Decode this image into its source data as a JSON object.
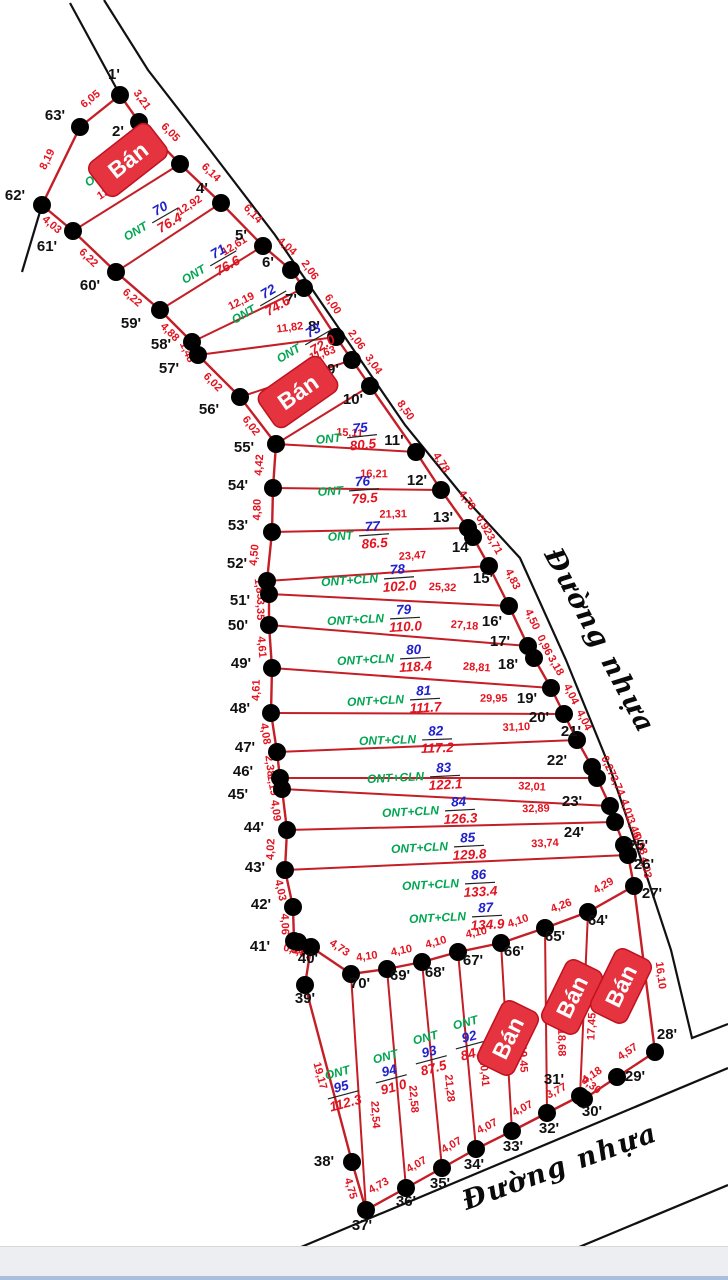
{
  "title": "Cadastral parcel sketch map",
  "colors": {
    "line": "#c41e26",
    "road": "#111111",
    "dot": "#000000",
    "edge_label": "#e4131f",
    "code": "#00a651",
    "num": "#2020cc",
    "area": "#e4131f",
    "badge_bg": "#e5333f",
    "badge_border": "#bf1120",
    "badge_text": "#ffffff",
    "vertex_label": "#111111",
    "bar": "#222222"
  },
  "roads": {
    "right_label": {
      "text": "Đường nhựa",
      "x": 592,
      "y": 645,
      "rot": 62,
      "size": 27
    },
    "bottom_label": {
      "text": "Đường nhựa",
      "x": 563,
      "y": 1175,
      "rot": -20,
      "size": 27
    },
    "lines": [
      [
        [
          104,
          0
        ],
        [
          148,
          70
        ],
        [
          210,
          150
        ],
        [
          275,
          235
        ],
        [
          340,
          330
        ],
        [
          405,
          425
        ],
        [
          462,
          495
        ],
        [
          520,
          558
        ],
        [
          566,
          660
        ],
        [
          610,
          768
        ],
        [
          648,
          880
        ],
        [
          671,
          950
        ],
        [
          692,
          1038
        ],
        [
          728,
          1024
        ]
      ],
      [
        [
          70,
          3
        ],
        [
          120,
          95
        ]
      ],
      [
        [
          42,
          205
        ],
        [
          22,
          272
        ]
      ],
      [
        [
          263,
          1263
        ],
        [
          728,
          1068
        ]
      ],
      [
        [
          500,
          1280
        ],
        [
          728,
          1185
        ]
      ]
    ]
  },
  "vertices": {
    "1": [
      120,
      95,
      -6,
      -16
    ],
    "2": [
      139,
      122,
      -21,
      14
    ],
    "3": [
      180,
      164,
      -20,
      -3
    ],
    "4": [
      221,
      203,
      -19,
      -10
    ],
    "5": [
      263,
      246,
      -22,
      -6
    ],
    "6": [
      291,
      270,
      -23,
      -3
    ],
    "7": [
      304,
      288,
      -13,
      16
    ],
    "8": [
      336,
      337,
      -22,
      -6
    ],
    "9": [
      352,
      360,
      -19,
      14
    ],
    "10": [
      370,
      386,
      -17,
      18
    ],
    "11": [
      416,
      452,
      -22,
      -7
    ],
    "12": [
      441,
      490,
      -24,
      -5
    ],
    "13": [
      468,
      528,
      -25,
      -6
    ],
    "13b": [
      473,
      537,
      0,
      0
    ],
    "14": [
      489,
      566,
      -27,
      -14
    ],
    "15": [
      509,
      606,
      -26,
      -23
    ],
    "16": [
      528,
      646,
      -36,
      -20
    ],
    "17": [
      534,
      658,
      -34,
      -12
    ],
    "18": [
      551,
      688,
      -43,
      -19
    ],
    "19": [
      564,
      714,
      -37,
      -11
    ],
    "20": [
      577,
      740,
      -38,
      -18
    ],
    "21": [
      592,
      767,
      -21,
      -31
    ],
    "22": [
      597,
      778,
      -40,
      -13
    ],
    "23": [
      610,
      806,
      -38,
      0
    ],
    "24": [
      615,
      822,
      -41,
      15
    ],
    "25": [
      624,
      845,
      14,
      5
    ],
    "26": [
      628,
      855,
      16,
      14
    ],
    "27": [
      634,
      886,
      18,
      12
    ],
    "28": [
      655,
      1052,
      12,
      -13
    ],
    "29": [
      617,
      1077,
      18,
      4
    ],
    "30": [
      584,
      1099,
      8,
      17
    ],
    "31": [
      580,
      1096,
      -26,
      -12
    ],
    "32": [
      547,
      1113,
      2,
      20
    ],
    "33": [
      512,
      1131,
      1,
      20
    ],
    "34": [
      476,
      1149,
      -2,
      20
    ],
    "35": [
      442,
      1168,
      -2,
      20
    ],
    "36": [
      406,
      1188,
      0,
      18
    ],
    "37": [
      366,
      1210,
      -4,
      20
    ],
    "38": [
      352,
      1162,
      -28,
      4
    ],
    "39": [
      305,
      985,
      0,
      18
    ],
    "40": [
      311,
      947,
      -3,
      16
    ],
    "41": [
      294,
      941,
      -34,
      10
    ],
    "41b": [
      298,
      942,
      0,
      0
    ],
    "42": [
      293,
      907,
      -32,
      2
    ],
    "43": [
      285,
      870,
      -30,
      2
    ],
    "44": [
      287,
      830,
      -33,
      2
    ],
    "45": [
      282,
      789,
      -44,
      10
    ],
    "46": [
      280,
      778,
      -37,
      -2
    ],
    "47": [
      277,
      752,
      -32,
      0
    ],
    "48": [
      271,
      713,
      -31,
      0
    ],
    "49": [
      272,
      668,
      -31,
      0
    ],
    "50": [
      269,
      625,
      -31,
      5
    ],
    "51": [
      269,
      594,
      -29,
      11
    ],
    "52": [
      267,
      581,
      -30,
      -13
    ],
    "53": [
      272,
      532,
      -34,
      -2
    ],
    "54": [
      273,
      488,
      -35,
      2
    ],
    "55": [
      276,
      444,
      -32,
      8
    ],
    "56": [
      240,
      397,
      -31,
      17
    ],
    "57": [
      198,
      355,
      -29,
      18
    ],
    "58": [
      192,
      342,
      -31,
      7
    ],
    "59": [
      160,
      310,
      -29,
      18
    ],
    "60": [
      116,
      272,
      -26,
      18
    ],
    "61": [
      73,
      231,
      -26,
      20
    ],
    "62": [
      42,
      205,
      -27,
      -5
    ],
    "63": [
      80,
      127,
      -25,
      -7
    ],
    "64": [
      588,
      912,
      10,
      13
    ],
    "65": [
      545,
      928,
      10,
      13
    ],
    "66": [
      501,
      943,
      13,
      13
    ],
    "67": [
      458,
      952,
      15,
      13
    ],
    "68": [
      422,
      962,
      13,
      15
    ],
    "69": [
      387,
      969,
      13,
      11
    ],
    "70": [
      351,
      974,
      9,
      14
    ]
  },
  "boundary_edges": [
    [
      "1",
      "2",
      "3,21",
      -1
    ],
    [
      "2",
      "3",
      "6,05",
      -1
    ],
    [
      "3",
      "4",
      "6,14",
      -1
    ],
    [
      "4",
      "5",
      "6,14",
      -1
    ],
    [
      "5",
      "6",
      "4,04",
      -1
    ],
    [
      "6",
      "7",
      "2,06",
      -1
    ],
    [
      "7",
      "8",
      "6,00",
      -1
    ],
    [
      "8",
      "9",
      "2,06",
      -1
    ],
    [
      "9",
      "10",
      "3,04",
      -1
    ],
    [
      "10",
      "11",
      "8,50",
      -1
    ],
    [
      "11",
      "12",
      "4,78",
      -1
    ],
    [
      "12",
      "13",
      "4,78",
      -1
    ],
    [
      "13",
      "13b",
      "0,92",
      -1
    ],
    [
      "13b",
      "14",
      "3,71",
      -1
    ],
    [
      "14",
      "15",
      "4,83",
      -1
    ],
    [
      "15",
      "16",
      "4,50",
      -1
    ],
    [
      "16",
      "17",
      "0,96",
      -1
    ],
    [
      "17",
      "18",
      "3,18",
      -1
    ],
    [
      "18",
      "19",
      "4,04",
      -1
    ],
    [
      "19",
      "20",
      "4,04",
      -1
    ],
    [
      "20",
      "21",
      "",
      -1
    ],
    [
      "21",
      "22",
      "0,27",
      -1
    ],
    [
      "22",
      "23",
      "3,74",
      -1
    ],
    [
      "23",
      "24",
      "4,01",
      -1
    ],
    [
      "24",
      "25",
      "3,46",
      -1
    ],
    [
      "25",
      "26",
      "0,98",
      -1
    ],
    [
      "26",
      "27",
      "4,03",
      -1
    ],
    [
      "27",
      "28",
      "16,10",
      -1,
      0.55
    ],
    [
      "27",
      "64",
      "4,29",
      1
    ],
    [
      "64",
      "65",
      "4,26",
      1
    ],
    [
      "65",
      "66",
      "4,10",
      1
    ],
    [
      "66",
      "67",
      "4,10",
      1
    ],
    [
      "67",
      "68",
      "4,10",
      1
    ],
    [
      "68",
      "69",
      "4,10",
      1
    ],
    [
      "69",
      "70",
      "4,10",
      1
    ],
    [
      "70",
      "40",
      "4,73",
      1
    ],
    [
      "1",
      "63",
      "6,05",
      1
    ],
    [
      "63",
      "62",
      "8,19",
      1
    ],
    [
      "62",
      "61",
      "4,03",
      1
    ],
    [
      "61",
      "60",
      "6,22",
      1
    ],
    [
      "60",
      "59",
      "6,22",
      1
    ],
    [
      "59",
      "58",
      "4,88",
      1
    ],
    [
      "58",
      "57",
      "1,48",
      1
    ],
    [
      "57",
      "56",
      "6,02",
      1
    ],
    [
      "56",
      "55",
      "6,02",
      1
    ],
    [
      "55",
      "54",
      "4,42",
      1
    ],
    [
      "54",
      "53",
      "4,80",
      1
    ],
    [
      "53",
      "52",
      "4,50",
      1
    ],
    [
      "52",
      "51",
      "1,85",
      1
    ],
    [
      "51",
      "50",
      "3,35",
      1
    ],
    [
      "50",
      "49",
      "4,61",
      1
    ],
    [
      "49",
      "48",
      "4,61",
      1
    ],
    [
      "48",
      "47",
      "4,08",
      1
    ],
    [
      "47",
      "46",
      "2,38",
      1
    ],
    [
      "46",
      "45",
      "1,19",
      1
    ],
    [
      "45",
      "44",
      "4,09",
      1
    ],
    [
      "44",
      "43",
      "4,02",
      1
    ],
    [
      "43",
      "42",
      "4,03",
      1
    ],
    [
      "42",
      "41",
      "4,06",
      1
    ],
    [
      "41",
      "41b",
      "0,44",
      1
    ],
    [
      "41b",
      "40",
      "3,57",
      1
    ],
    [
      "40",
      "39",
      "",
      1
    ],
    [
      "39",
      "38",
      "19,17",
      1
    ],
    [
      "38",
      "37",
      "4,75",
      1
    ],
    [
      "37",
      "36",
      "4,73",
      -1
    ],
    [
      "36",
      "35",
      "4,07",
      -1
    ],
    [
      "35",
      "34",
      "4,07",
      -1
    ],
    [
      "34",
      "33",
      "4,07",
      -1
    ],
    [
      "33",
      "32",
      "4,07",
      -1
    ],
    [
      "32",
      "31",
      "3,77",
      -1
    ],
    [
      "31",
      "30",
      "0,30",
      -1
    ],
    [
      "30",
      "29",
      "4,18",
      -1
    ],
    [
      "29",
      "28",
      "4,57",
      -1
    ]
  ],
  "dividers": [
    [
      "61",
      "3",
      "13,23",
      0.42
    ],
    [
      "60",
      "4",
      "12,92",
      0.78
    ],
    [
      "59",
      "5",
      "12,61",
      0.8
    ],
    [
      "58",
      "7",
      "12,19",
      0.5
    ],
    [
      "57",
      "8",
      "11,82",
      0.68
    ],
    [
      "56",
      "9",
      "11,63",
      0.78
    ],
    [
      "55",
      "10",
      "",
      0.5
    ],
    [
      "55",
      "11",
      "15,11",
      0.52
    ],
    [
      "54",
      "12",
      "16,21",
      0.6
    ],
    [
      "53",
      "13",
      "21,31",
      0.62
    ],
    [
      "52",
      "14",
      "23,47",
      0.66
    ],
    [
      "51",
      "15",
      "25,32",
      0.72
    ],
    [
      "50",
      "16",
      "27,18",
      0.75
    ],
    [
      "49",
      "18",
      "28,81",
      0.73
    ],
    [
      "48",
      "19",
      "29,95",
      0.76
    ],
    [
      "47",
      "20",
      "31,10",
      0.8
    ],
    [
      "46",
      "22",
      "",
      0.5
    ],
    [
      "45",
      "23",
      "32,01",
      0.76
    ],
    [
      "44",
      "24",
      "32,89",
      0.76
    ],
    [
      "43",
      "26",
      "33,74",
      0.76
    ],
    [
      "70",
      "37",
      "22,54",
      0.6
    ],
    [
      "69",
      "36",
      "22,58",
      0.6
    ],
    [
      "68",
      "35",
      "21,28",
      0.62
    ],
    [
      "67",
      "34",
      "20,41",
      0.62
    ],
    [
      "66",
      "33",
      "19,45",
      0.62
    ],
    [
      "65",
      "32",
      "18,68",
      0.62
    ],
    [
      "64",
      "31",
      "17,45",
      0.62
    ]
  ],
  "parcels": [
    {
      "num": "",
      "code": "ONT",
      "area": "",
      "x": 110,
      "y": 167,
      "rot": -35,
      "stack": false
    },
    {
      "num": "70",
      "code": "ONT",
      "area": "76.4",
      "x": 150,
      "y": 223,
      "rot": -30,
      "stack": false
    },
    {
      "num": "71",
      "code": "ONT",
      "area": "76.6",
      "x": 208,
      "y": 266,
      "rot": -30,
      "stack": false
    },
    {
      "num": "72",
      "code": "ONT",
      "area": "74.6",
      "x": 258,
      "y": 306,
      "rot": -30,
      "stack": false
    },
    {
      "num": "73",
      "code": "ONT",
      "area": "72.0",
      "x": 303,
      "y": 345,
      "rot": -30,
      "stack": false
    },
    {
      "num": "75",
      "code": "ONT",
      "area": "80.5",
      "x": 345,
      "y": 437,
      "rot": -6,
      "stack": false
    },
    {
      "num": "76",
      "code": "ONT",
      "area": "79.5",
      "x": 347,
      "y": 490,
      "rot": -4,
      "stack": false
    },
    {
      "num": "77",
      "code": "ONT",
      "area": "86.5",
      "x": 357,
      "y": 535,
      "rot": -4,
      "stack": false
    },
    {
      "num": "78",
      "code": "ONT+CLN",
      "area": "102.0",
      "x": 382,
      "y": 578,
      "rot": -4,
      "stack": false
    },
    {
      "num": "79",
      "code": "ONT+CLN",
      "area": "110.0",
      "x": 388,
      "y": 618,
      "rot": -3,
      "stack": false
    },
    {
      "num": "80",
      "code": "ONT+CLN",
      "area": "118.4",
      "x": 398,
      "y": 658,
      "rot": -3,
      "stack": false
    },
    {
      "num": "81",
      "code": "ONT+CLN",
      "area": "111.7",
      "x": 408,
      "y": 699,
      "rot": -3,
      "stack": false
    },
    {
      "num": "82",
      "code": "ONT+CLN",
      "area": "117.2",
      "x": 420,
      "y": 739,
      "rot": -2,
      "stack": false
    },
    {
      "num": "83",
      "code": "ONT+CLN",
      "area": "122.1",
      "x": 428,
      "y": 776,
      "rot": -3,
      "stack": false
    },
    {
      "num": "84",
      "code": "ONT+CLN",
      "area": "126.3",
      "x": 443,
      "y": 810,
      "rot": -3,
      "stack": false
    },
    {
      "num": "85",
      "code": "ONT+CLN",
      "area": "129.8",
      "x": 452,
      "y": 846,
      "rot": -3,
      "stack": false
    },
    {
      "num": "86",
      "code": "ONT+CLN",
      "area": "133.4",
      "x": 463,
      "y": 883,
      "rot": -3,
      "stack": false
    },
    {
      "num": "87",
      "code": "ONT+CLN",
      "area": "134.9",
      "x": 470,
      "y": 916,
      "rot": -3,
      "stack": false
    },
    {
      "num": "92",
      "code": "ONT",
      "area": "84.0",
      "x": 470,
      "y": 1040,
      "rot": -15,
      "stack": true
    },
    {
      "num": "93",
      "code": "ONT",
      "area": "87.5",
      "x": 430,
      "y": 1055,
      "rot": -15,
      "stack": true
    },
    {
      "num": "94",
      "code": "ONT",
      "area": "91.0",
      "x": 390,
      "y": 1074,
      "rot": -15,
      "stack": true
    },
    {
      "num": "95",
      "code": "ONT",
      "area": "112.3",
      "x": 342,
      "y": 1090,
      "rot": -15,
      "stack": true
    }
  ],
  "badges": [
    {
      "text": "Bán",
      "x": 128,
      "y": 160,
      "rot": -38,
      "w": 76,
      "h": 42
    },
    {
      "text": "Bán",
      "x": 298,
      "y": 392,
      "rot": -35,
      "w": 76,
      "h": 42
    },
    {
      "text": "Bán",
      "x": 508,
      "y": 1038,
      "rot": -64,
      "w": 70,
      "h": 40
    },
    {
      "text": "Bán",
      "x": 572,
      "y": 997,
      "rot": -64,
      "w": 70,
      "h": 40
    },
    {
      "text": "Bán",
      "x": 621,
      "y": 986,
      "rot": -64,
      "w": 70,
      "h": 40
    }
  ],
  "footer": {
    "visible": true
  }
}
